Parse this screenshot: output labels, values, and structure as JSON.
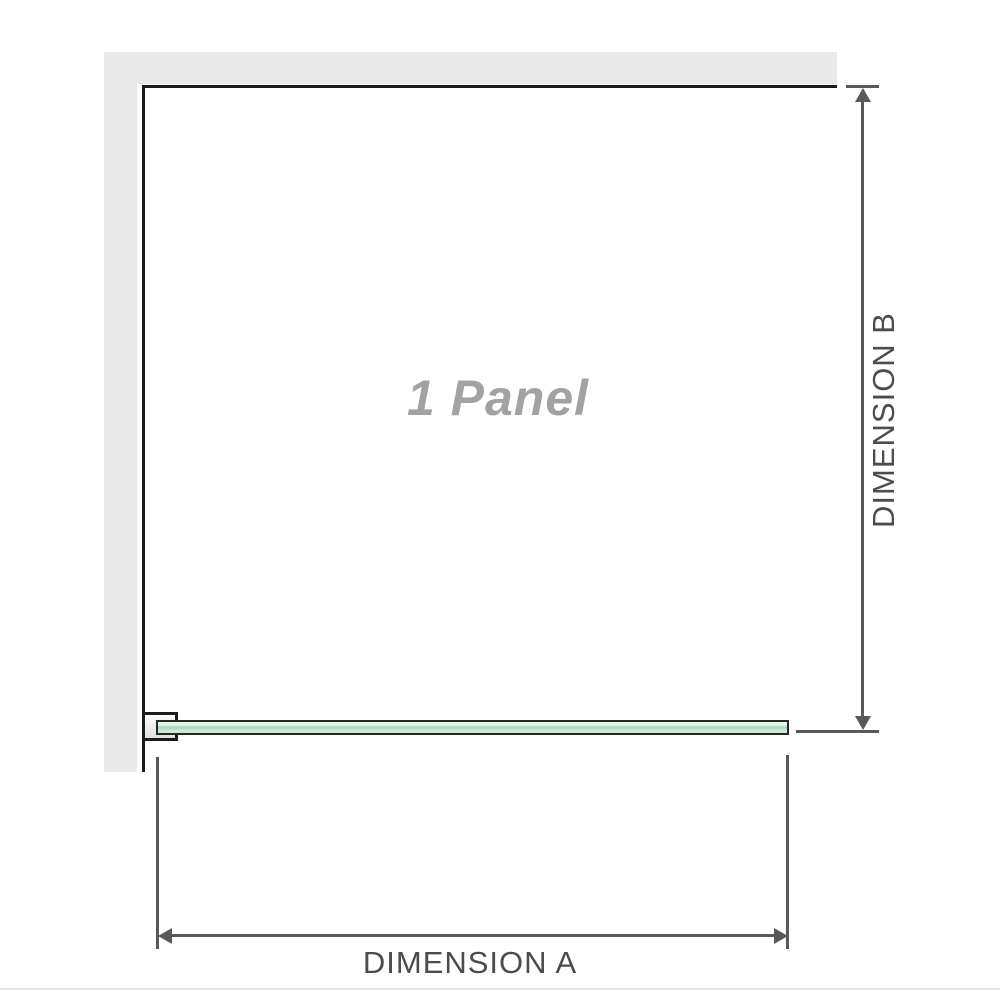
{
  "diagram": {
    "panel_label": "1 Panel",
    "dimension_a_label": "DIMENSION A",
    "dimension_b_label": "DIMENSION B"
  },
  "colors": {
    "bg": "#ffffff",
    "wall": "#e9e9e9",
    "frame": "#1b1b1b",
    "dim-line": "#58595b",
    "dim-text": "#4b4c4e",
    "panel-text": "#a2a2a2",
    "glass-border": "#242924",
    "glass-light": "#e8f4ed",
    "glass-mid": "#a3d5b7",
    "glass-soft": "#cde9d8",
    "bracket-a": "#fdfdfd",
    "bracket-b": "#e0e0e0",
    "baseline": "#e6e6e2"
  }
}
